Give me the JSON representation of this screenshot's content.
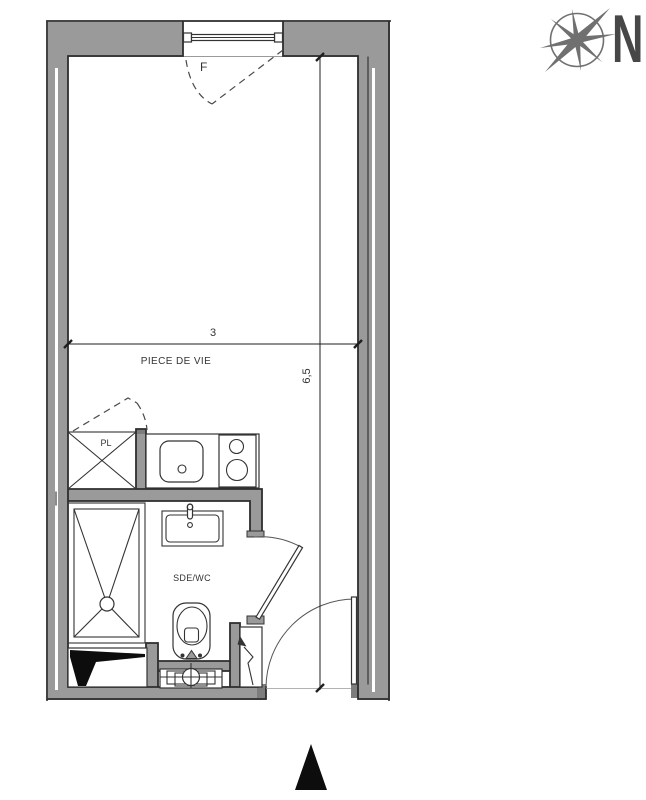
{
  "plan": {
    "labels": {
      "living_room": "PIECE DE VIE",
      "bathroom": "SDE/WC",
      "closet": "PL",
      "window": "F"
    },
    "dimensions": {
      "width": "3",
      "depth": "6,5"
    },
    "compass_north": "N"
  },
  "colors": {
    "background": "#ffffff",
    "wall_fill": "#9a9a9a",
    "wall_dark": "#7d7d7d",
    "outline": "#2d2d2d",
    "fixture": "#333333",
    "dash": "#4a4a4a",
    "dimension": "#1f1f1f",
    "compass": "#707070",
    "north_text": "#474747",
    "entrance_marker": "#0d0d0d"
  }
}
